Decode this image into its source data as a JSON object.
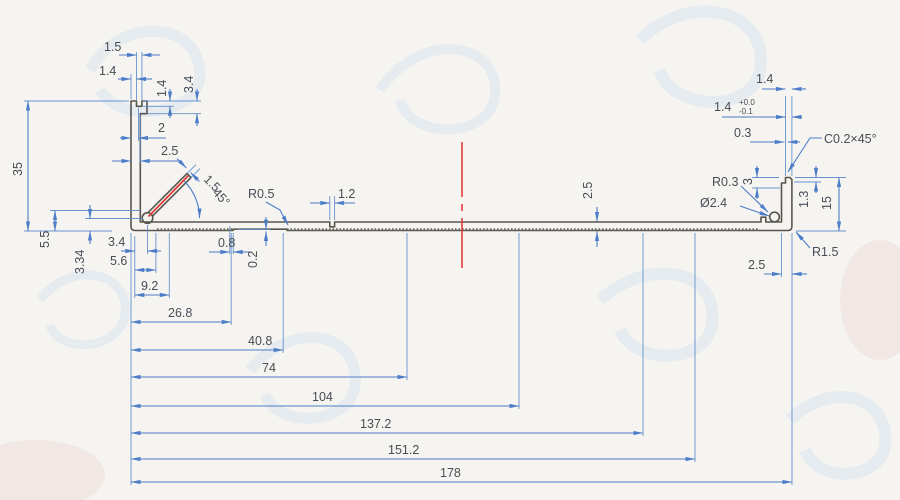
{
  "drawing": {
    "type": "aluminum-extrusion-profile-cross-section",
    "colors": {
      "paper": "#f5f4f0",
      "dimension_blue": "#4d7dc8",
      "outline_gray": "#57564e",
      "accent_red": "#e23a3a",
      "text": "#474d56"
    }
  },
  "dims": {
    "notch_width": "1.5",
    "top_lip": "1.4",
    "notch_depth": "1.4",
    "head_depth": "3.4",
    "lip_to_notch": "2",
    "wall_thickness": "2.5",
    "left_height": "35",
    "boss_height": "5.5",
    "boss_center_height": "3.34",
    "boss_offset": "3.4",
    "base_step1": "5.6",
    "base_step2": "9.2",
    "len_26_8": "26.8",
    "len_40_8": "40.8",
    "len_74": "74",
    "len_104": "104",
    "len_137_2": "137.2",
    "len_151_2": "151.2",
    "total_width": "178",
    "step_width": "0.8",
    "step_height": "0.2",
    "fillet_r05": "R0.5",
    "slot_width": "1.2",
    "base_thickness": "2.5",
    "fin_thickness": "1.5",
    "fin_angle": "45°",
    "right_tip_width": "1.4",
    "right_tip_width_tol": "1.4",
    "tol_plus": "+0.0",
    "tol_minus": "-0.1",
    "right_offset": "0.3",
    "chamfer": "C0.2×45°",
    "right_step": "3",
    "fillet_r03": "R0.3",
    "boss_dia": "Ø2.4",
    "right_lip": "1.3",
    "right_height": "15",
    "fillet_r15": "R1.5",
    "right_wall_thickness": "2.5"
  }
}
